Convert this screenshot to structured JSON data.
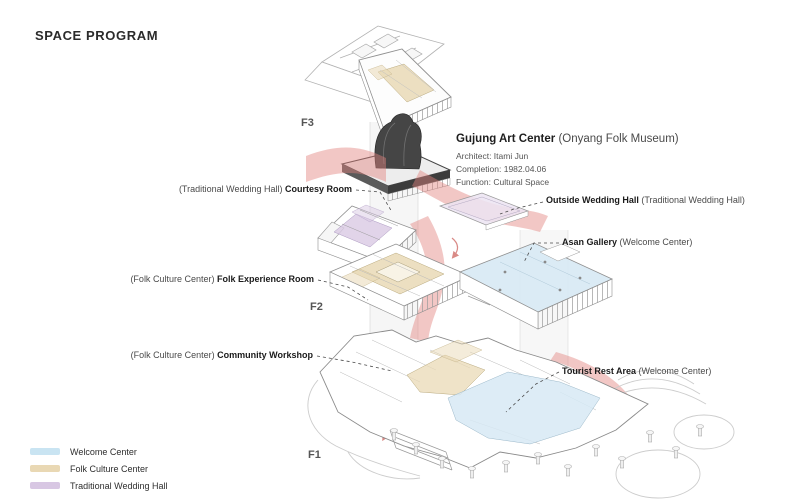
{
  "title": "SPACE PROGRAM",
  "info": {
    "name": "Gujung Art Center",
    "name_paren": "(Onyang Folk Museum)",
    "lines": [
      "Architect: Itami Jun",
      "Completion: 1982.04.06",
      "Function: Cultural Space"
    ]
  },
  "floors": [
    {
      "label": "F3"
    },
    {
      "label": "F2"
    },
    {
      "label": "F1"
    }
  ],
  "annotations": [
    {
      "id": "courtesy-room",
      "pre": "(Traditional Wedding Hall) ",
      "bold": "Courtesy Room",
      "post": ""
    },
    {
      "id": "outside-wedding-hall",
      "pre": "",
      "bold": "Outside Wedding Hall",
      "post": " (Traditional Wedding Hall)"
    },
    {
      "id": "asan-gallery",
      "pre": "",
      "bold": "Asan Gallery",
      "post": " (Welcome Center)"
    },
    {
      "id": "folk-experience-room",
      "pre": "(Folk Culture Center) ",
      "bold": "Folk Experience Room",
      "post": ""
    },
    {
      "id": "community-workshop",
      "pre": "(Folk Culture Center) ",
      "bold": "Community Workshop",
      "post": ""
    },
    {
      "id": "tourist-rest-area",
      "pre": "",
      "bold": "Tourist Rest Area",
      "post": " (Welcome Center)"
    }
  ],
  "legend": [
    {
      "label": "Welcome Center",
      "color": "#c9e4f2"
    },
    {
      "label": "Folk Culture Center",
      "color": "#e9d8b4"
    },
    {
      "label": "Traditional Wedding Hall",
      "color": "#d8c7e3"
    }
  ],
  "colors": {
    "circulation_flow": "#e2827e",
    "tower_roof": "#454545",
    "linework": "#9b9b9b"
  }
}
